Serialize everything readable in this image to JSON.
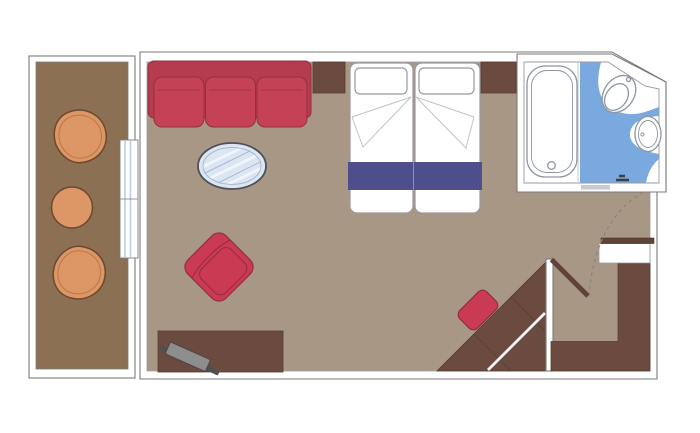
{
  "plan": {
    "kind": "cabin-floor-plan",
    "rooms": [
      "balcony",
      "living-bedroom",
      "bathroom",
      "entrance-corridor"
    ],
    "furniture": [
      "balcony-chair",
      "balcony-table",
      "balcony-chair",
      "sliding-glass-door",
      "sofa",
      "coffee-table",
      "armchair",
      "nightstand",
      "double-bed",
      "bed-runner",
      "nightstand",
      "tv-cabinet",
      "tv",
      "desk",
      "desk-stool",
      "wardrobe",
      "entry-door",
      "bathtub",
      "toilet",
      "sink"
    ]
  },
  "colors": {
    "wall-fill": "#ffffff",
    "wall-line": "#7a7a7a",
    "inner-line": "#9a9aa0",
    "floor": "#a99786",
    "balcony-floor": "#8b7053",
    "wood": "#6b4b3f",
    "wood-dark": "#5f4337",
    "wood-line": "#553a30",
    "wood-edge": "#4a332b",
    "seam": "#5b4036",
    "sofa-base": "#b53b4e",
    "sofa-cushion": "#c44254",
    "sofa-line": "#93303f",
    "chair-red": "#ca3a52",
    "chair-line": "#962b3d",
    "orange": "#dd9766",
    "orange-line": "#6f472a",
    "orange-inner": "#b87647",
    "navy": "#4e4e8c",
    "bath-blue": "#79a9de",
    "fixture-line": "#8e96a0",
    "glass-fill": "#dce6f2",
    "glass-line": "#50505c",
    "glass-stripe": "#f2f5fb",
    "glass-inner": "#a8b6cf",
    "glass-door-blue": "#b9cfe8",
    "door-arc": "#8e8276",
    "tv-gray": "#8d8d8d",
    "tv-dark": "#4f4f4f",
    "tv-edge": "#46464b",
    "fold-line": "#c2c2c8",
    "track-gray": "#c7cbd1",
    "handle-dark": "#3c3f45",
    "divider": "#c3cad2",
    "white-stripe": "#f2f2f2"
  }
}
